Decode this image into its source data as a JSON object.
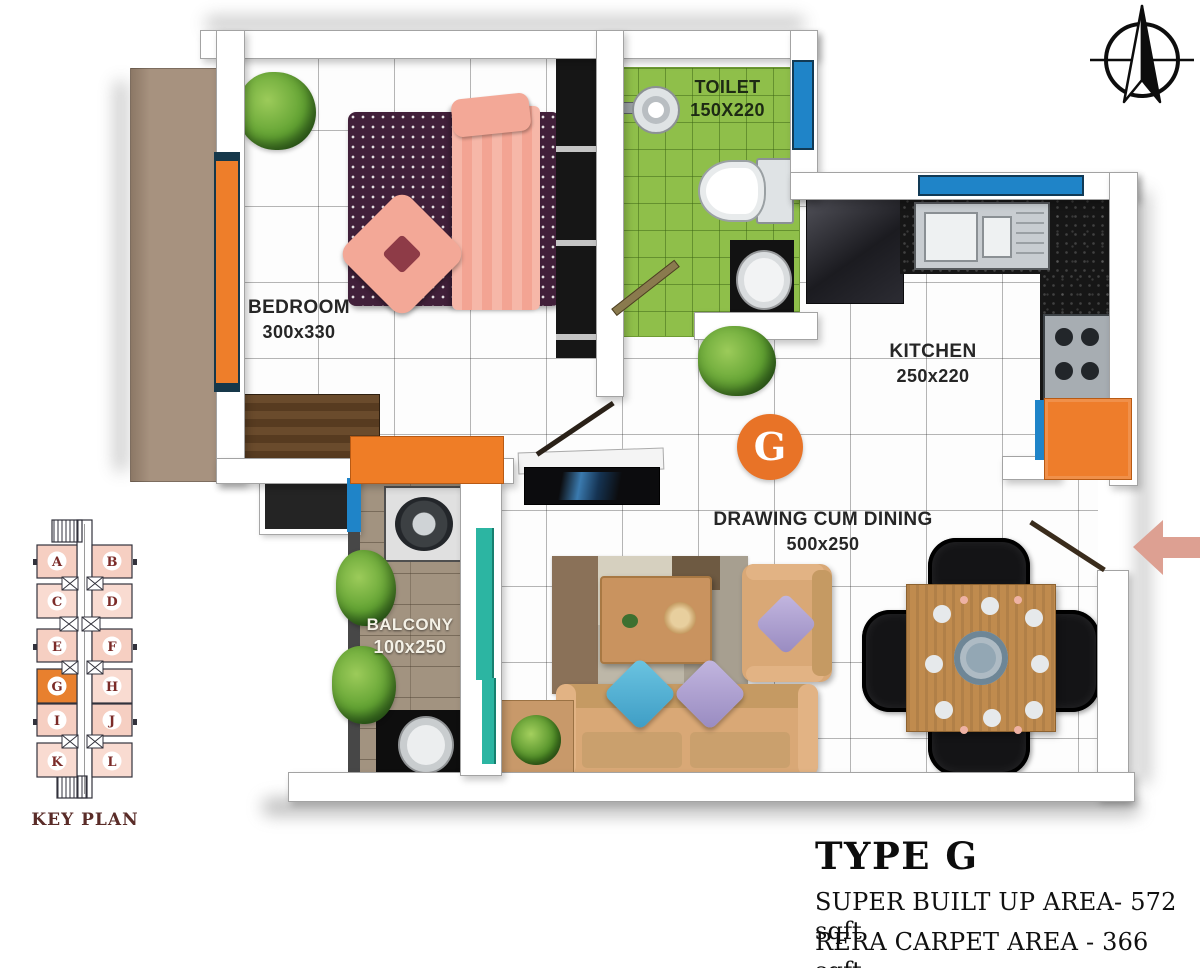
{
  "plan": {
    "badge": "G",
    "rooms": {
      "bedroom": {
        "name": "BEDROOM",
        "dims": "300x330"
      },
      "toilet": {
        "name": "TOILET",
        "dims": "150X220"
      },
      "kitchen": {
        "name": "KITCHEN",
        "dims": "250x220"
      },
      "hall": {
        "name": "DRAWING CUM DINING",
        "dims": "500x250"
      },
      "balcony": {
        "name": "BALCONY",
        "dims": "100x250"
      }
    }
  },
  "key_plan": {
    "caption": "KEY PLAN",
    "units": [
      "A",
      "B",
      "C",
      "D",
      "E",
      "F",
      "G",
      "H",
      "I",
      "J",
      "K",
      "L"
    ],
    "highlighted_unit": "G"
  },
  "title_block": {
    "type": "TYPE G",
    "super_built_up": "SUPER BUILT UP AREA- 572 sqft",
    "rera_carpet": "RERA CARPET AREA - 366 sqft"
  },
  "colors": {
    "accent_orange": "#e87327",
    "arrow_salmon": "#dda092",
    "toilet_green": "#8fbf4a",
    "teal_accent": "#2cb5a2",
    "window_blue": "#1f84c8",
    "keyplan_pink": "#f6cfc2",
    "letter_maroon": "#7b2b28"
  },
  "icons": {
    "compass": "north-compass",
    "entry_arrow": "entry-direction-left"
  }
}
